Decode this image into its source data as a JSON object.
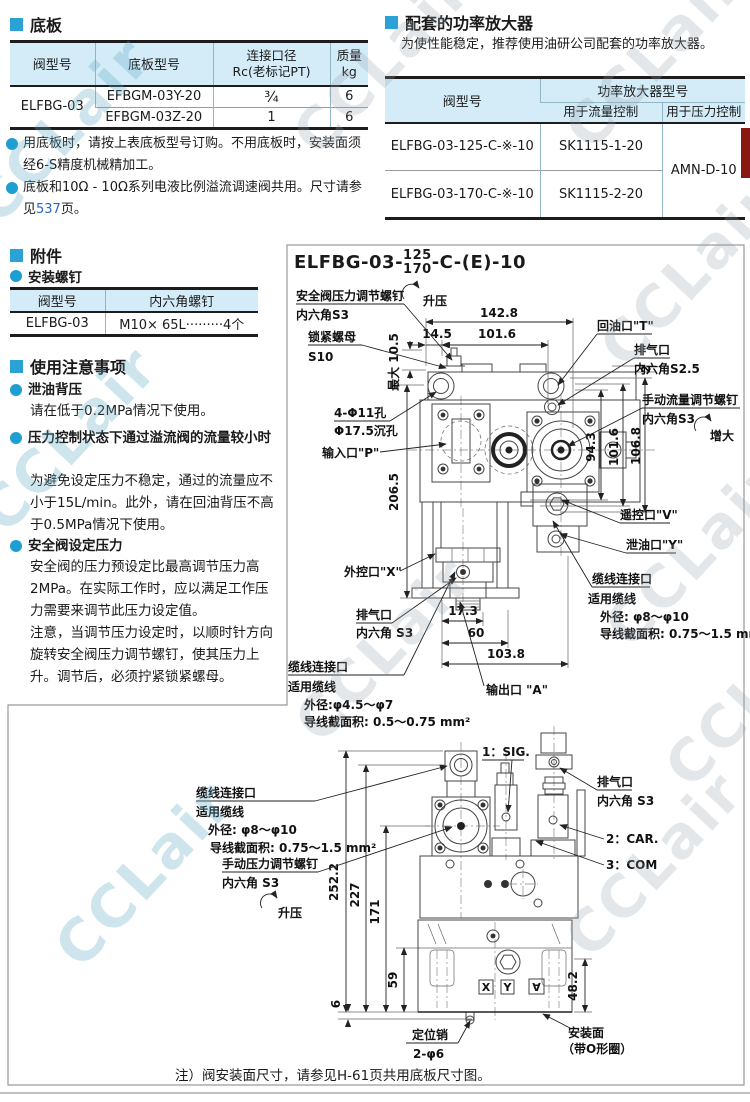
{
  "watermark": "CCLair",
  "sec1": {
    "title": "底板",
    "table": {
      "h_valve": "阀型号",
      "h_plate": "底板型号",
      "h_conn1": "连接口径",
      "h_conn2": "Rc(老标记PT)",
      "h_mass1": "质量",
      "h_mass2": "kg",
      "valve": "ELFBG-03",
      "r1_plate": "EFBGM-03Y-20",
      "r1_conn": "¾",
      "r1_mass": "6",
      "r2_plate": "EFBGM-03Z-20",
      "r2_conn": "1",
      "r2_mass": "6"
    },
    "note1": "用底板时，请按上表底板型号订购。不用底板时，安装面须经6-S精度机械精加工。",
    "note2a": "底板和10Ω - 10Ω系列电液比例溢流调速阀共用。尺寸请参见",
    "note2_link": "537",
    "note2b": "页。"
  },
  "sec2": {
    "title": "配套的功率放大器",
    "desc": "为使性能稳定，推荐使用油研公司配套的功率放大器。",
    "table": {
      "h_valve": "阀型号",
      "h_amp": "功率放大器型号",
      "h_flow": "用于流量控制",
      "h_press": "用于压力控制",
      "r1_valve": "ELFBG-03-125-C-※-10",
      "r1_flow": "SK1115-1-20",
      "r2_valve": "ELFBG-03-170-C-※-10",
      "r2_flow": "SK1115-2-20",
      "press": "AMN-D-10"
    }
  },
  "sec3": {
    "title": "附件",
    "sub": "安装螺钉",
    "table": {
      "h_valve": "阀型号",
      "h_screw": "内六角螺钉",
      "valve": "ELFBG-03",
      "screw": "M10× 65L·········4个"
    }
  },
  "prec": {
    "title": "使用注意事项",
    "p1_head": "泄油背压",
    "p1_body": "请在低于0.2MPa情况下使用。",
    "p2_head": "压力控制状态下通过溢流阀的流量较小时",
    "p2_body": "为避免设定压力不稳定，通过的流量应不小于15L/min。此外，请在回油背压不高于0.5MPa情况下使用。",
    "p3_head": "安全阀设定压力",
    "p3_body1": "安全阀的压力预设定比最高调节压力高 2MPa。在实际工作时，应以满足工作压力需要来调节此压力设定值。",
    "p3_body2": "注意，当调节压力设定时，以顺时针方向旋转安全阀压力调节螺钉，使其压力上升。调节后，必须拧紧锁紧螺母。"
  },
  "d1": {
    "title_pre": "ELFBG-03-",
    "num_top": "125",
    "num_bot": "170",
    "title_suf": "-C-(E)-10",
    "lbl_safety": "安全阀压力调节螺钉",
    "lbl_hex_s3": "内六角S3",
    "lbl_rise": "升压",
    "lbl_locknut": "锁紧螺母",
    "lbl_s10": "S10",
    "dim_max105": "最大 10.5",
    "dim_1428": "142.8",
    "dim_145": "14.5",
    "dim_1016a": "101.6",
    "lbl_holes1": "4-Φ11孔",
    "lbl_holes2": "Φ17.5沉孔",
    "lbl_in_p": "输入口\"P\"",
    "dim_2065": "206.5",
    "lbl_ext_x": "外控口\"X\"",
    "lbl_vent": "排气口",
    "lbl_vent_hex": "内六角 S3",
    "cbl1_1": "缆线连接口",
    "cbl1_2": "适用缆线",
    "cbl1_3": "外径:φ4.5～φ7",
    "cbl1_4": "导线截面积: 0.5～0.75 mm²",
    "lbl_return_t": "回油口\"T\"",
    "lbl_vent2": "排气口",
    "lbl_vent2_hex": "内六角S2.5",
    "dim_2": "2",
    "lbl_flow1": "手动流量调节螺钉",
    "lbl_flow2": "内六角S3",
    "lbl_inc": "增大",
    "dim_943": "94.3",
    "dim_1016b": "101.6",
    "dim_1068": "106.8",
    "lbl_v": "遥控口\"V\"",
    "lbl_y": "泄油口\"Y\"",
    "cbl2_1": "缆线连接口",
    "cbl2_2": "适用缆线",
    "cbl2_3": "外径: φ8～φ10",
    "cbl2_4": "导线截面积: 0.75～1.5 mm²",
    "dim_173": "17.3",
    "dim_60": "60",
    "dim_1038": "103.8",
    "lbl_out_a": "输出口 \"A\""
  },
  "d2": {
    "cbl_1": "缆线连接口",
    "cbl_2": "适用缆线",
    "cbl_3": "外径: φ8～φ10",
    "cbl_4": "导线截面积: 0.75～1.5 mm²",
    "lbl_press1": "手动压力调节螺钉",
    "lbl_press2": "内六角 S3",
    "lbl_rise": "升压",
    "lbl_sig": "1：SIG.",
    "lbl_car": "2：CAR.",
    "lbl_com": "3：COM",
    "lbl_vent": "排气口",
    "lbl_vent_hex": "内六角 S3",
    "dim_2522": "252.2",
    "dim_227": "227",
    "dim_171": "171",
    "dim_59": "59",
    "dim_6": "6",
    "dim_482": "48.2",
    "lbl_pin1": "定位销",
    "lbl_pin2": "2-φ6",
    "lbl_mount1": "安装面",
    "lbl_mount2": "（带O形圈）",
    "sym_x": "X",
    "sym_y": "Y",
    "sym_a": "∀"
  },
  "note_bottom": "注）阀安装面尺寸，请参见H-61页共用底板尺寸图。"
}
